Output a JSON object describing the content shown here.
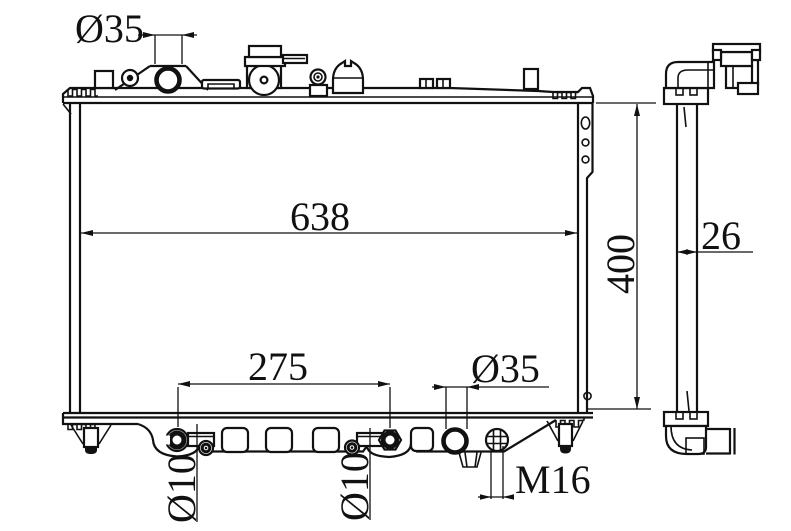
{
  "drawing": {
    "subject": "radiator technical drawing",
    "background": "#ffffff",
    "line_color": "#111111",
    "dimensions": {
      "inlet_diameter": "Ø35",
      "overall_width": "638",
      "overall_height": "400",
      "core_thickness": "26",
      "pin_spacing": "275",
      "outlet_diameter": "Ø35",
      "pin_diameter_left": "Ø10",
      "pin_diameter_right": "Ø10",
      "drain_thread": "M16"
    }
  }
}
